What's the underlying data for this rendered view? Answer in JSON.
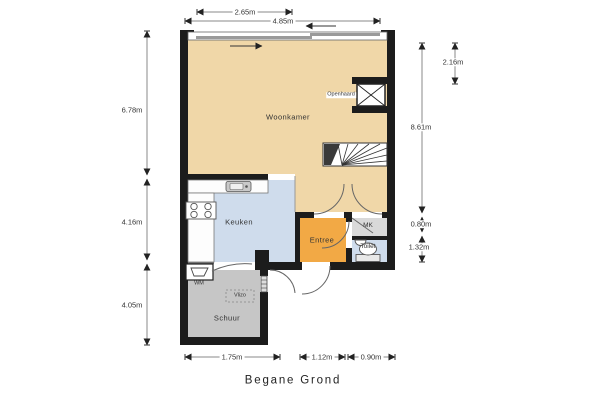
{
  "title": "Begane Grond",
  "colors": {
    "wall": "#1c1c1c",
    "woonkamer": "#f0d7a8",
    "keuken": "#cfdcec",
    "entree": "#f2a945",
    "mk": "#d9d9d9",
    "toilet": "#cfdcec",
    "schuur": "#c6c6c6",
    "window": "#9a9a9a",
    "dim": "#777777",
    "text": "#333333",
    "bg": "#ffffff"
  },
  "rooms": {
    "woonkamer": {
      "label": "Woonkamer"
    },
    "keuken": {
      "label": "Keuken"
    },
    "entree": {
      "label": "Entree"
    },
    "mk": {
      "label": "MK"
    },
    "toilet": {
      "label": "Toilet"
    },
    "schuur": {
      "label": "Schuur"
    }
  },
  "fixtures": {
    "openhaard": {
      "label": "Openhaard"
    },
    "wm": {
      "label": "WM"
    },
    "vlizo": {
      "label": "Vlizo"
    }
  },
  "dimensions": {
    "top": [
      {
        "value": "2.65m"
      },
      {
        "value": "4.85m"
      }
    ],
    "left": [
      {
        "value": "6.78m"
      },
      {
        "value": "4.16m"
      },
      {
        "value": "4.05m"
      }
    ],
    "right": [
      {
        "value": "2.16m"
      },
      {
        "value": "8.61m"
      },
      {
        "value": "0.80m"
      },
      {
        "value": "1.32m"
      }
    ],
    "bottom": [
      {
        "value": "1.75m"
      },
      {
        "value": "1.12m"
      },
      {
        "value": "0.90m"
      }
    ]
  }
}
